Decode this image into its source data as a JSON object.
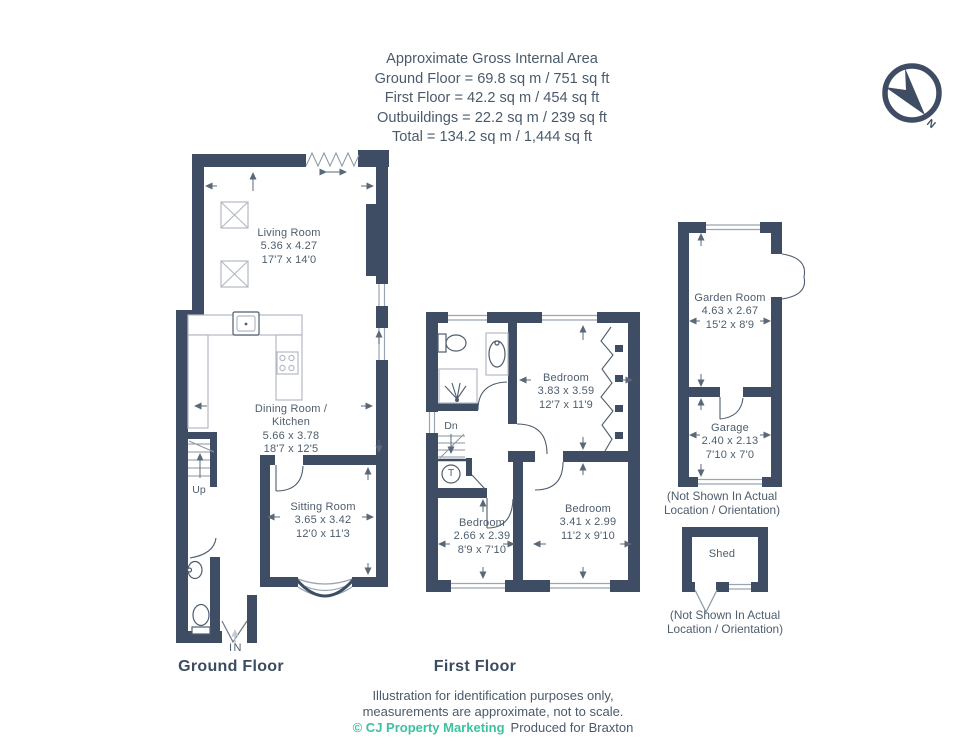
{
  "header": {
    "title": "Approximate Gross Internal Area",
    "ground": "Ground Floor = 69.8 sq m / 751 sq ft",
    "first": "First Floor = 42.2 sq m / 454 sq ft",
    "outbuildings": "Outbuildings = 22.2 sq m / 239 sq ft",
    "total": "Total = 134.2 sq m / 1,444 sq ft"
  },
  "compass": {
    "north_label": "N"
  },
  "ground_floor": {
    "floor_label": "Ground Floor",
    "stairs_label": "Up",
    "entrance_label": "IN",
    "living_room": {
      "name": "Living Room",
      "metric": "5.36 x 4.27",
      "imperial": "17'7 x 14'0"
    },
    "dining_kitchen": {
      "name_line1": "Dining Room /",
      "name_line2": "Kitchen",
      "metric": "5.66 x 3.78",
      "imperial": "18'7 x 12'5"
    },
    "sitting_room": {
      "name": "Sitting Room",
      "metric": "3.65 x 3.42",
      "imperial": "12'0 x 11'3"
    }
  },
  "first_floor": {
    "floor_label": "First Floor",
    "stairs_label": "Dn",
    "tank_label": "T",
    "bedroom_1": {
      "name": "Bedroom",
      "metric": "3.83 x 3.59",
      "imperial": "12'7 x 11'9"
    },
    "bedroom_2": {
      "name": "Bedroom",
      "metric": "2.66 x 2.39",
      "imperial": "8'9 x 7'10"
    },
    "bedroom_3": {
      "name": "Bedroom",
      "metric": "3.41 x 2.99",
      "imperial": "11'2 x 9'10"
    }
  },
  "outbuildings": {
    "garden_room": {
      "name": "Garden Room",
      "metric": "4.63 x 2.67",
      "imperial": "15'2 x 8'9"
    },
    "garage": {
      "name": "Garage",
      "metric": "2.40 x 2.13",
      "imperial": "7'10 x 7'0"
    },
    "shed": {
      "name": "Shed"
    },
    "note_line1": "(Not Shown In Actual",
    "note_line2": "Location / Orientation)"
  },
  "footer": {
    "line1": "Illustration for identification purposes only,",
    "line2": "measurements are approximate, not to scale.",
    "credit": "© CJ Property Marketing",
    "produced": "Produced for Braxton"
  },
  "colors": {
    "wall": "#3e4d63",
    "text": "#4e5d6d",
    "accent_teal": "#3cc2a0",
    "fixture_gray": "#b3bac4"
  }
}
